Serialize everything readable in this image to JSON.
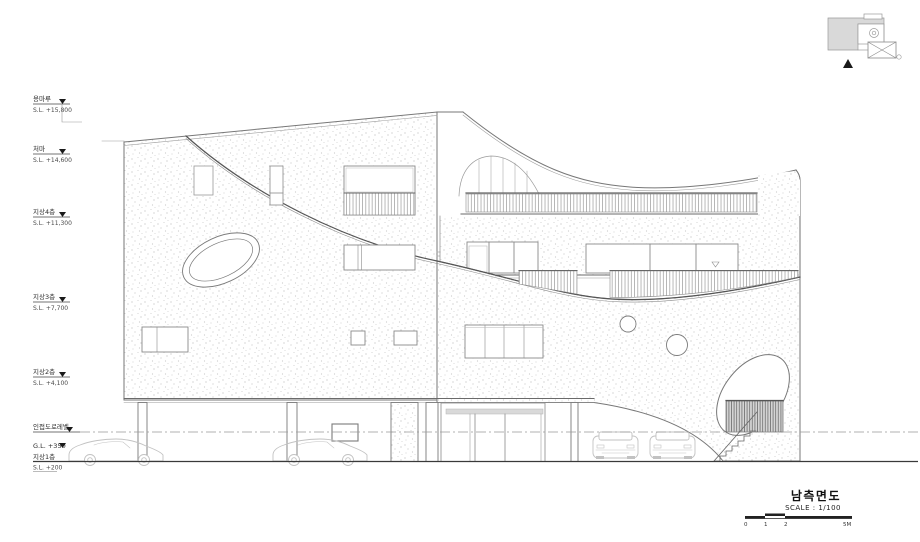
{
  "drawing": {
    "kind": "architectural south elevation",
    "title": "남측면도",
    "scale_label": "SCALE : 1/100",
    "scale_ticks": [
      "0",
      "1",
      "2",
      "5M"
    ]
  },
  "level_markers": [
    {
      "name": "용마루",
      "elevation": "S.L. +15,800"
    },
    {
      "name": "처마",
      "elevation": "S.L. +14,600"
    },
    {
      "name": "지상4층",
      "elevation": "S.L. +11,300"
    },
    {
      "name": "지상3층",
      "elevation": "S.L. +7,700"
    },
    {
      "name": "지상2층",
      "elevation": "S.L. +4,100"
    },
    {
      "name": "인접도로레벨",
      "elevation": ""
    },
    {
      "name": "G.L. +350",
      "elevation": ""
    },
    {
      "name": "지상1층",
      "elevation": "S.L. +200"
    }
  ],
  "symbols": {
    "level_marker": "▼",
    "window_sill_mark": "▽",
    "keyplan_view_arrow": "▲"
  },
  "colors": {
    "line_dark": "#555555",
    "line_mid": "#888888",
    "line_light": "#bbbbbb",
    "stipple_dot": "#c6c6c6",
    "keyplan_fill": "#d9d9d9",
    "marker_fill": "#1a1a1a",
    "car_line": "#c2c2c2"
  }
}
